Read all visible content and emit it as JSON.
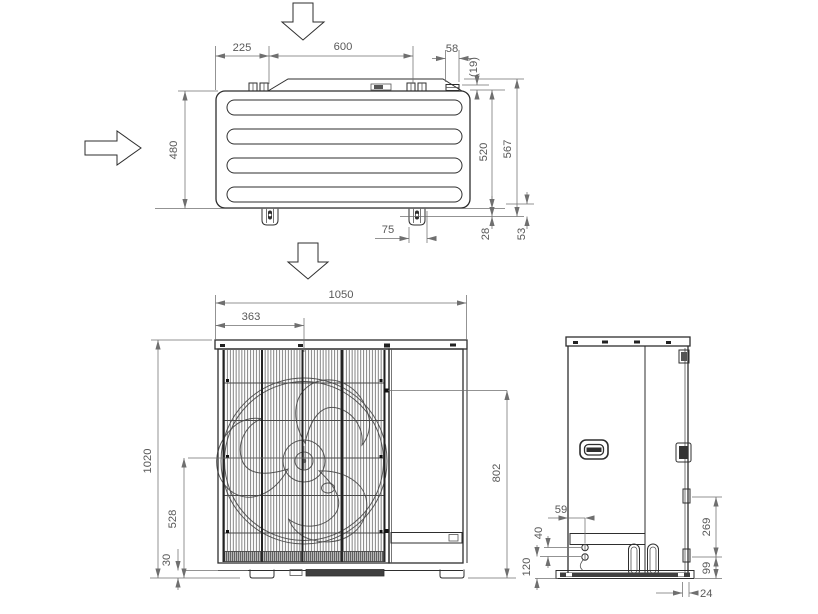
{
  "drawing": {
    "type": "technical-dimension-drawing",
    "subject": "air-conditioner-outdoor-unit-3-views",
    "colors": {
      "line": "#2e2e2e",
      "dimension": "#6f6f6f",
      "text": "#595959",
      "background": "#ffffff"
    }
  },
  "dims": {
    "top": {
      "left_offset": "225",
      "panel_width": "600",
      "bracket_width": "58",
      "clip_height": "(19)",
      "depth": "480",
      "depth_to_foot": "520",
      "overall_depth": "567",
      "foot_pitch": "75",
      "foot_height": "28",
      "foot_clearance": "53"
    },
    "front": {
      "overall_width": "1050",
      "fan_center_x": "363",
      "overall_height": "1020",
      "fan_center_y": "528",
      "base_height": "30",
      "knockout_height": "802"
    },
    "side": {
      "hole_offset": "59",
      "hole_pitch": "40",
      "hole_height": "120",
      "pipe_zone_height": "269",
      "outlet_height": "99",
      "base_inset": "24"
    }
  }
}
